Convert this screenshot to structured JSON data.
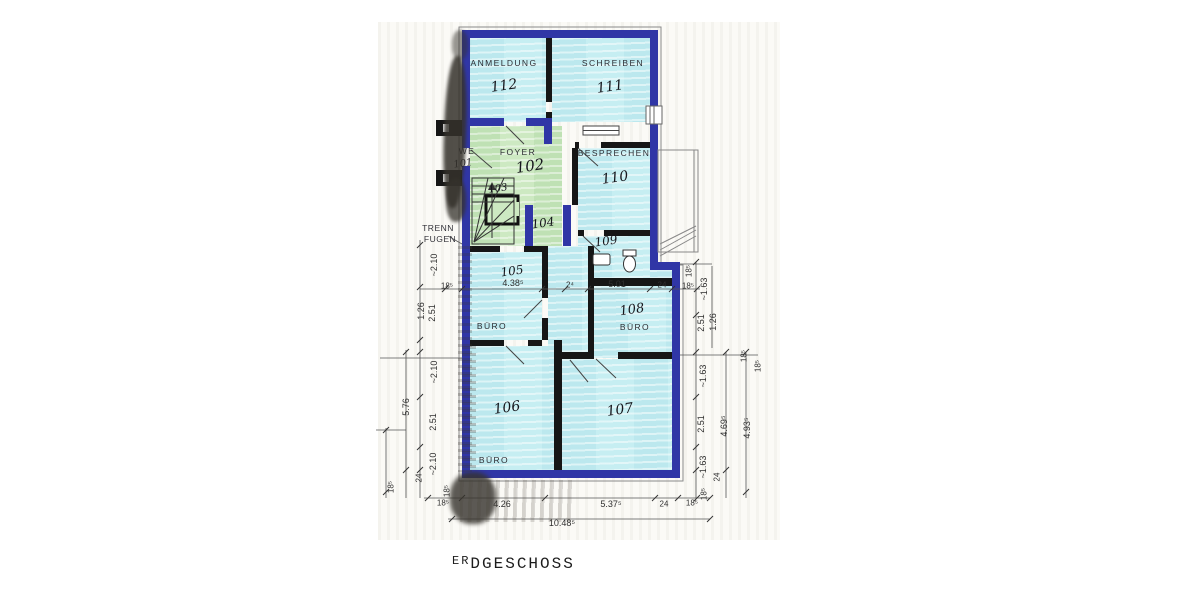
{
  "title": {
    "prefix": "ER",
    "rest": "DGESCHOSS"
  },
  "colors": {
    "wall-blue": "#3036a6",
    "room-cyan": "#c6eef2",
    "room-green": "#cde9c2",
    "line-dark": "#444444"
  },
  "rooms": {
    "r112": {
      "name": "ANMELDUNG",
      "number": "112"
    },
    "r111": {
      "name": "SCHREIBEN",
      "number": "111"
    },
    "r101": {
      "name": "WE",
      "number": "101"
    },
    "r102": {
      "name": "FOYER",
      "number": "102"
    },
    "r103": {
      "number": "103"
    },
    "r104": {
      "number": "104"
    },
    "r110": {
      "name": "BESPRECHEN",
      "number": "110"
    },
    "r109": {
      "number": "109"
    },
    "r105": {
      "name": "BÜRO",
      "number": "105"
    },
    "r108": {
      "name": "BÜRO",
      "number": "108"
    },
    "r106": {
      "name": "BÜRO",
      "number": "106"
    },
    "r107": {
      "number": "107"
    }
  },
  "annotations": {
    "trenn": "TRENN",
    "fugen": "FUGEN"
  },
  "dims": {
    "mid": [
      "18⁵",
      "4.38⁵",
      "2⁴",
      "5.01",
      "24",
      "18⁵"
    ],
    "bottom": [
      "18⁵",
      "4.26",
      "5.37⁵",
      "24",
      "18⁵"
    ],
    "bottom_total": "10.48⁵",
    "left": [
      "~2.10",
      "2.51",
      "1.26",
      "~2.10",
      "2.51",
      "~2.10",
      "5.76",
      "24",
      "18⁵",
      "18⁵"
    ],
    "right": [
      "18⁵",
      "~1.63",
      "2.51",
      "1.26",
      "18⁵",
      "~1.63",
      "2.51",
      "~1.63",
      "24",
      "4.69⁵",
      "4.93⁵",
      "18⁵",
      "18⁵"
    ]
  }
}
